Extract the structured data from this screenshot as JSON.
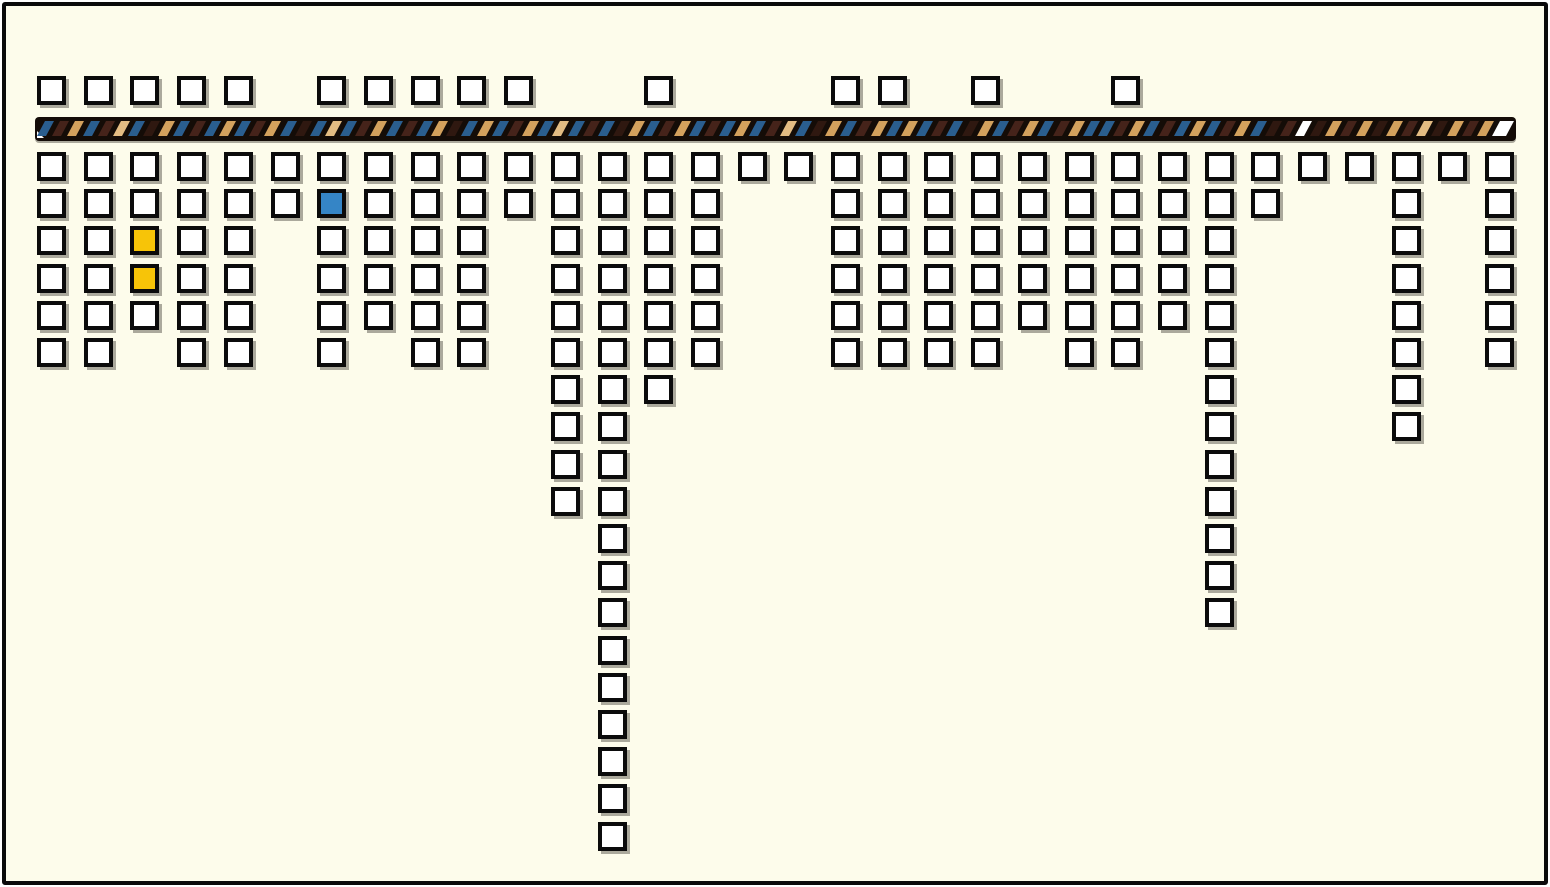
{
  "palette": {
    "page_background": "#FFFFFF",
    "panel_background": "#FDFCEB",
    "frame_border": "#0A0A0A",
    "square_border": "#0B0B0B",
    "square_fill": "#FFFFFF",
    "square_shadow": "#ABA99C",
    "highlight_yellow": "#F7C408",
    "highlight_blue": "#3585C6",
    "band_background": "#140C07"
  },
  "band": {
    "stripe_colors": {
      "B": "#2A5E8F",
      "D": "#45231A",
      "K": "#2F1810",
      "T": "#D3A15D",
      "L": "#E3BC83",
      "W": "#FFFFFF"
    },
    "sequence": "BDTBDLBKTBDBTBDTBKBLBDTBDBTKBTBDTBLBDBKTBDTBDBTBDLBKTBDTBTBDBKTBDTBDTBBDTBDBTBDTBKDWKTDTKTDLKTDTW",
    "end_cap_color": "W"
  },
  "chart_data": {
    "type": "bar",
    "title": "",
    "xlabel": "",
    "ylabel": "",
    "description_of_encoding": "32 column positions along a horizontal woven band; white unit squares above the band mark certain columns; each column hangs a stack of white unit squares below the band; three cells are color-highlighted",
    "columns": 32,
    "x_index": [
      1,
      2,
      3,
      4,
      5,
      6,
      7,
      8,
      9,
      10,
      11,
      12,
      13,
      14,
      15,
      16,
      17,
      18,
      19,
      20,
      21,
      22,
      23,
      24,
      25,
      26,
      27,
      28,
      29,
      30,
      31,
      32
    ],
    "above_band_marker": [
      1,
      1,
      1,
      1,
      1,
      0,
      1,
      1,
      1,
      1,
      1,
      0,
      0,
      1,
      0,
      0,
      0,
      1,
      1,
      0,
      1,
      0,
      0,
      1,
      0,
      0,
      0,
      0,
      0,
      0,
      0,
      0
    ],
    "below_counts": [
      6,
      6,
      5,
      6,
      6,
      2,
      6,
      5,
      6,
      6,
      2,
      10,
      19,
      7,
      6,
      1,
      1,
      6,
      6,
      6,
      6,
      5,
      6,
      6,
      5,
      13,
      2,
      1,
      1,
      8,
      1,
      6
    ],
    "max_below_count": 19,
    "total_squares_above": 15,
    "total_squares_below": 178,
    "highlighted_cells": [
      {
        "column": 3,
        "row": 3,
        "color": "#F7C408",
        "name": "yellow"
      },
      {
        "column": 3,
        "row": 4,
        "color": "#F7C408",
        "name": "yellow"
      },
      {
        "column": 7,
        "row": 2,
        "color": "#3585C6",
        "name": "blue"
      }
    ],
    "grid": false,
    "legend": false
  }
}
